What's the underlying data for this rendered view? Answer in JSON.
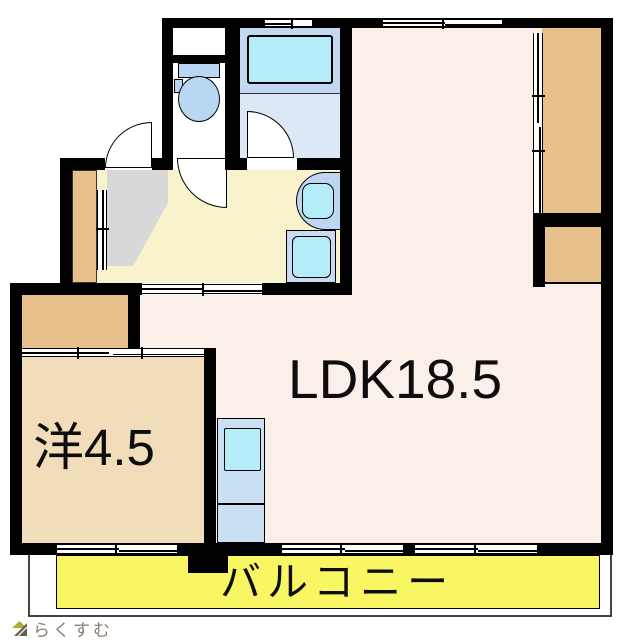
{
  "labels": {
    "ldk": "LDK18.5",
    "western_room": "洋4.5",
    "balcony": "バルコニー"
  },
  "logo": {
    "text": "らくすむ",
    "icon": "house-icon"
  },
  "rooms": [
    {
      "name": "ldk",
      "label": "LDK18.5"
    },
    {
      "name": "western-room",
      "label": "洋4.5"
    },
    {
      "name": "balcony",
      "label": "バルコニー"
    },
    {
      "name": "bathroom",
      "label": ""
    },
    {
      "name": "toilet-room",
      "label": ""
    },
    {
      "name": "washroom",
      "label": ""
    },
    {
      "name": "entrance-genkan",
      "label": ""
    }
  ],
  "colors": {
    "wall": "#000000",
    "ldk_floor": "#faefe9",
    "washroom_floor": "#f8f3cd",
    "genkan": "#d8d8d8",
    "room_floor": "#f2ddbb",
    "closet": "#e7c08c",
    "balcony": "#f8f763",
    "fixture_blue": "#b9d7f2",
    "counter_blue": "#bdd6f2",
    "tub_cyan": "#b4edf8",
    "bath_upper": "#c3d8f2",
    "bath_lower": "#dde8f6",
    "kitchen_blue": "#c9e0f5",
    "wm_blue": "#cddbf2",
    "logo_text": "#8b7d72",
    "logo_green": "#a9ad3c",
    "logo_brown": "#6d5c50"
  }
}
